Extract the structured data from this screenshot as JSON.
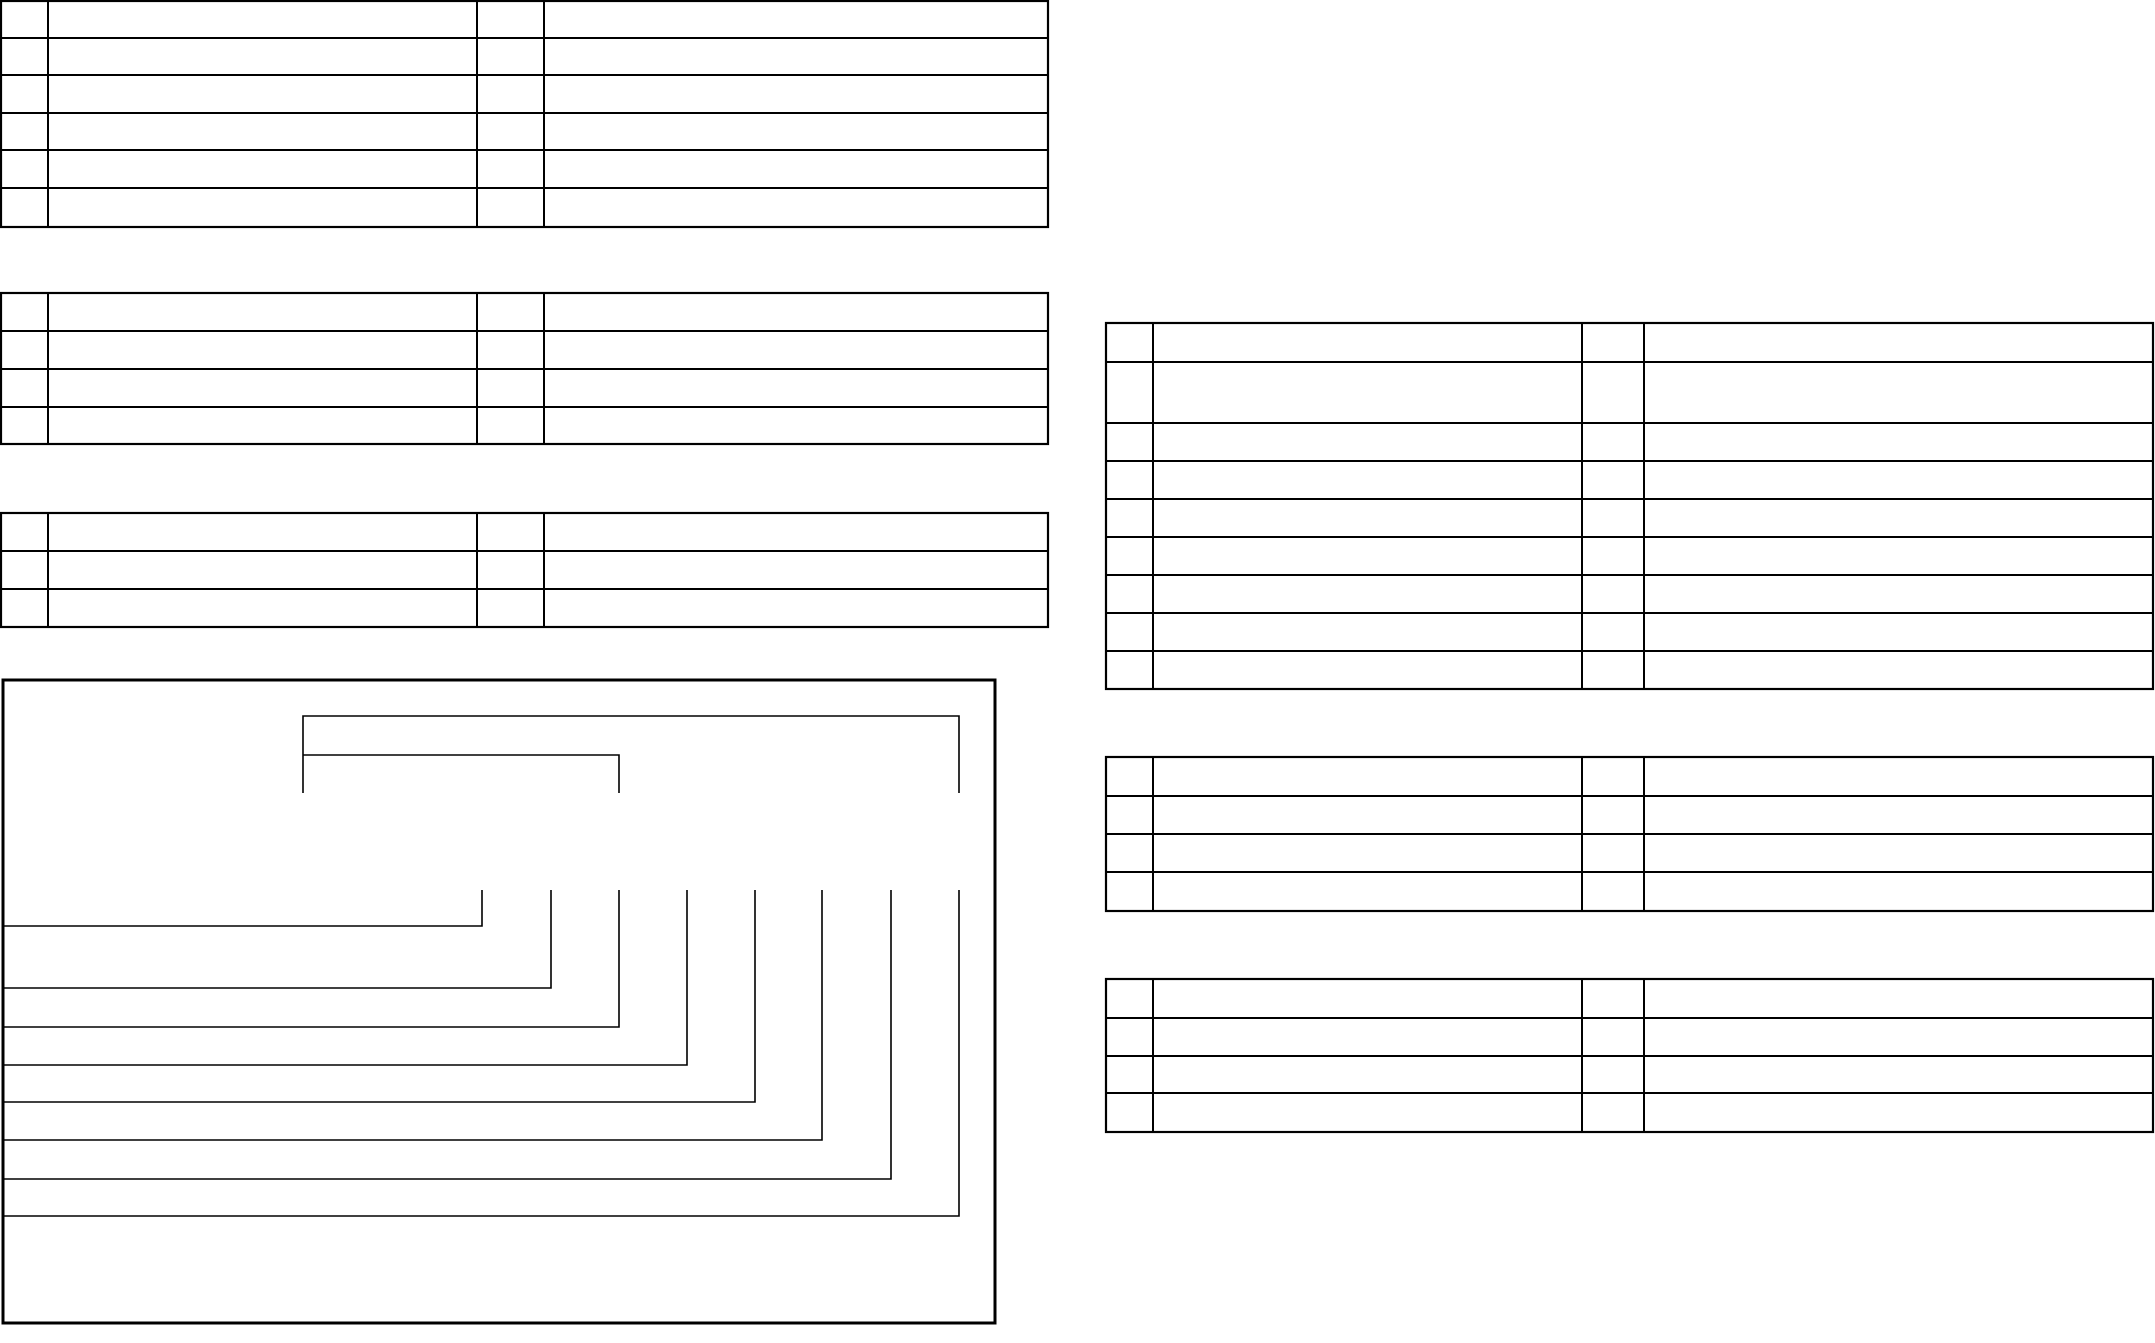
{
  "page": {
    "width": 2155,
    "height": 1343,
    "background_color": "#ffffff",
    "line_color": "#000000"
  },
  "table_style": {
    "outer_stroke_width": 2.2,
    "inner_stroke_width": 2
  },
  "tables": [
    {
      "id": "table-top-left",
      "rows": 6,
      "cols": 4,
      "col_edges": [
        1,
        48,
        477,
        544,
        1048
      ],
      "row_edges": [
        1,
        38,
        75,
        113,
        150,
        188,
        227
      ]
    },
    {
      "id": "table-mid-left",
      "rows": 4,
      "cols": 4,
      "col_edges": [
        1,
        48,
        477,
        544,
        1048
      ],
      "row_edges": [
        293,
        331,
        369,
        407,
        444
      ]
    },
    {
      "id": "table-lower-left",
      "rows": 3,
      "cols": 4,
      "col_edges": [
        1,
        48,
        477,
        544,
        1048
      ],
      "row_edges": [
        513,
        551,
        589,
        627
      ]
    },
    {
      "id": "table-right-1",
      "rows": 9,
      "cols": 4,
      "col_edges": [
        1106,
        1153,
        1582,
        1644,
        2153
      ],
      "row_edges": [
        323,
        362,
        423,
        461,
        499,
        537,
        575,
        613,
        651,
        689
      ]
    },
    {
      "id": "table-right-2",
      "rows": 4,
      "cols": 4,
      "col_edges": [
        1106,
        1153,
        1582,
        1644,
        2153
      ],
      "row_edges": [
        757,
        796,
        834,
        872,
        911
      ]
    },
    {
      "id": "table-right-3",
      "rows": 4,
      "cols": 4,
      "col_edges": [
        1106,
        1153,
        1582,
        1644,
        2153
      ],
      "row_edges": [
        979,
        1018,
        1056,
        1093,
        1132
      ]
    }
  ],
  "diagram": {
    "stroke_width": 1.6,
    "border": {
      "x1": 3,
      "y1": 680,
      "x2": 995,
      "y2": 1323,
      "stroke_width": 3
    },
    "brackets": [
      {
        "points": [
          [
            303,
            793
          ],
          [
            303,
            716
          ],
          [
            959,
            716
          ],
          [
            959,
            793
          ]
        ]
      },
      {
        "points": [
          [
            303,
            755
          ],
          [
            619,
            755
          ],
          [
            619,
            793
          ]
        ]
      }
    ],
    "callouts": {
      "stem_top_y": 890,
      "left_x": 3,
      "items": [
        {
          "x": 482,
          "line_y": 926
        },
        {
          "x": 551,
          "line_y": 988
        },
        {
          "x": 619,
          "line_y": 1027
        },
        {
          "x": 687,
          "line_y": 1065
        },
        {
          "x": 755,
          "line_y": 1102
        },
        {
          "x": 822,
          "line_y": 1140
        },
        {
          "x": 891,
          "line_y": 1179
        },
        {
          "x": 959,
          "line_y": 1216
        }
      ]
    }
  }
}
